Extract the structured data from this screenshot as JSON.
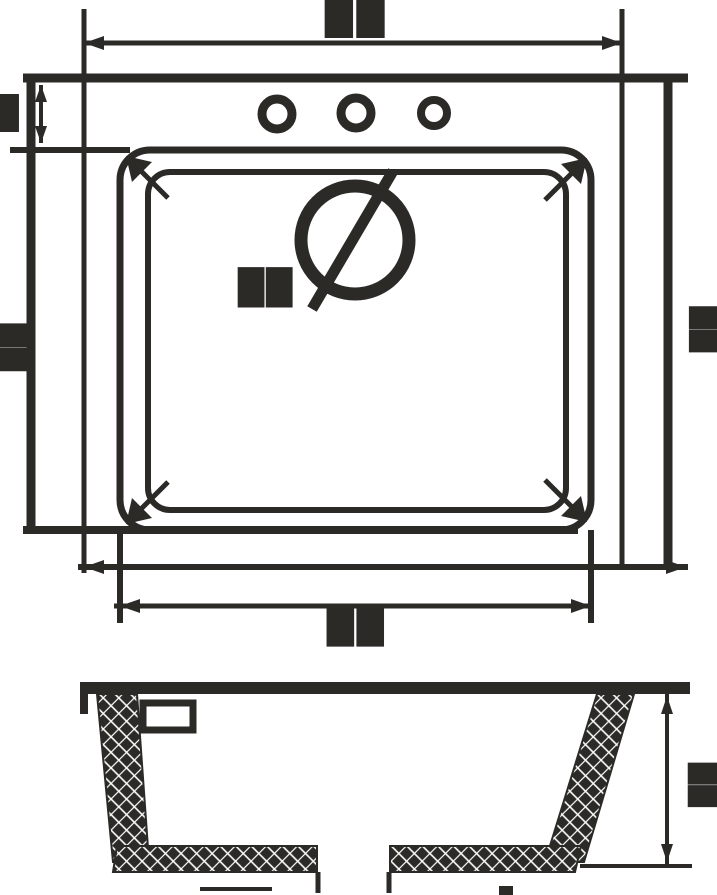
{
  "drawing": {
    "title": "",
    "colors": {
      "ink": "#2b2a27",
      "paper": "#ffffff"
    },
    "labels": {
      "top_width": "██",
      "rim_offset_left": "█",
      "height_left": "██",
      "drain": "██",
      "bowl_width_bottom": "██",
      "height_right": "██",
      "section_depth": "██"
    }
  }
}
